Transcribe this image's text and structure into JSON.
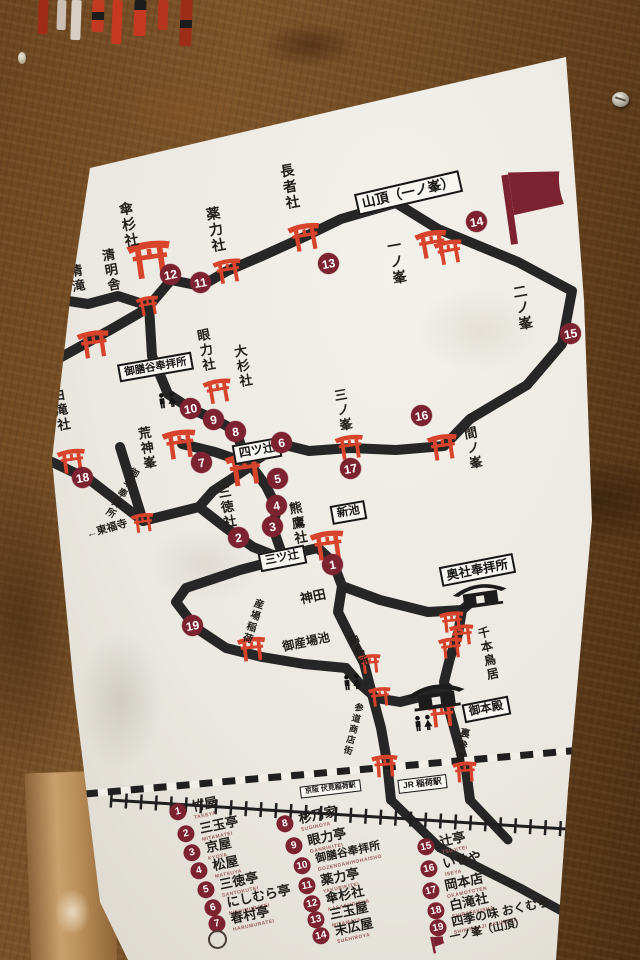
{
  "sign": {
    "boxes": {
      "santcho": "山頂（一ノ峯）",
      "gozendani": "御膳谷奉拝所",
      "yotsutsuji": "四ツ辻",
      "shinike": "新池",
      "mitsutsuji": "三ツ辻",
      "okusha": "奥社奉拝所",
      "gohonden": "御本殿",
      "keihan_station": "京阪 伏見稲荷駅",
      "jr_station": "JR 稲荷駅"
    },
    "place_labels": [
      "長者社",
      "薬力社",
      "傘杉社",
      "清明舎",
      "清滝",
      "眼力社",
      "大杉社",
      "荒神峯",
      "白滝社",
      "一ノ峯",
      "二ノ峯",
      "三ノ峯",
      "間ノ峯",
      "三徳社",
      "熊鷹社",
      "千本鳥居",
      "納札所",
      "産場稲荷",
      "参道商店街",
      "裏参道",
      "御幸奉拝所",
      "神田",
      "御産場池",
      "←東福寺"
    ],
    "markers": [
      "1",
      "2",
      "3",
      "4",
      "5",
      "6",
      "7",
      "8",
      "9",
      "10",
      "11",
      "12",
      "13",
      "14",
      "15",
      "16",
      "17",
      "18",
      "19"
    ],
    "legend": [
      {
        "num": "1",
        "name": "竹屋",
        "romaji": "TAKEYA"
      },
      {
        "num": "2",
        "name": "三玉亭",
        "romaji": "MITAMATEI"
      },
      {
        "num": "3",
        "name": "京屋",
        "romaji": "KYOYA"
      },
      {
        "num": "4",
        "name": "松屋",
        "romaji": "MATSUYA"
      },
      {
        "num": "5",
        "name": "三徳亭",
        "romaji": "SANTOKUTEI"
      },
      {
        "num": "6",
        "name": "にしむら亭",
        "romaji": "NISHIMURATEI"
      },
      {
        "num": "7",
        "name": "春村亭",
        "romaji": "HARUMURATEI"
      },
      {
        "num": "8",
        "name": "杉乃家",
        "romaji": "SUGINOYA"
      },
      {
        "num": "9",
        "name": "眼力亭",
        "romaji": "GANRIKITEI"
      },
      {
        "num": "10",
        "name": "御膳谷奉拝所",
        "romaji": "GOZENDANIHOHAISHO"
      },
      {
        "num": "11",
        "name": "薬力亭",
        "romaji": "YAKURIKITEI"
      },
      {
        "num": "12",
        "name": "傘杉社",
        "romaji": "KASASUGISHA"
      },
      {
        "num": "13",
        "name": "三玉屋",
        "romaji": "MITAMAYA"
      },
      {
        "num": "14",
        "name": "末広屋",
        "romaji": "SUEHIROYA"
      },
      {
        "num": "15",
        "name": "辻亭",
        "romaji": "TSUJITEI"
      },
      {
        "num": "16",
        "name": "いせや",
        "romaji": "ISEYA"
      },
      {
        "num": "17",
        "name": "岡本店",
        "romaji": "OKAMOTOTEN"
      },
      {
        "num": "18",
        "name": "白滝社",
        "romaji": "SHIRATAKISHA"
      },
      {
        "num": "19",
        "name": "四季の味 おくむら",
        "romaji": "SHIKINOAJI OKUMURA"
      },
      {
        "num": "flag",
        "name": "一ノ峯（山頂）",
        "romaji": ""
      }
    ],
    "colors": {
      "path": "#262626",
      "torii": "#d8432b",
      "marker": "#7d2230",
      "board": "#ebe8e1",
      "wood": "#6b4421"
    }
  }
}
